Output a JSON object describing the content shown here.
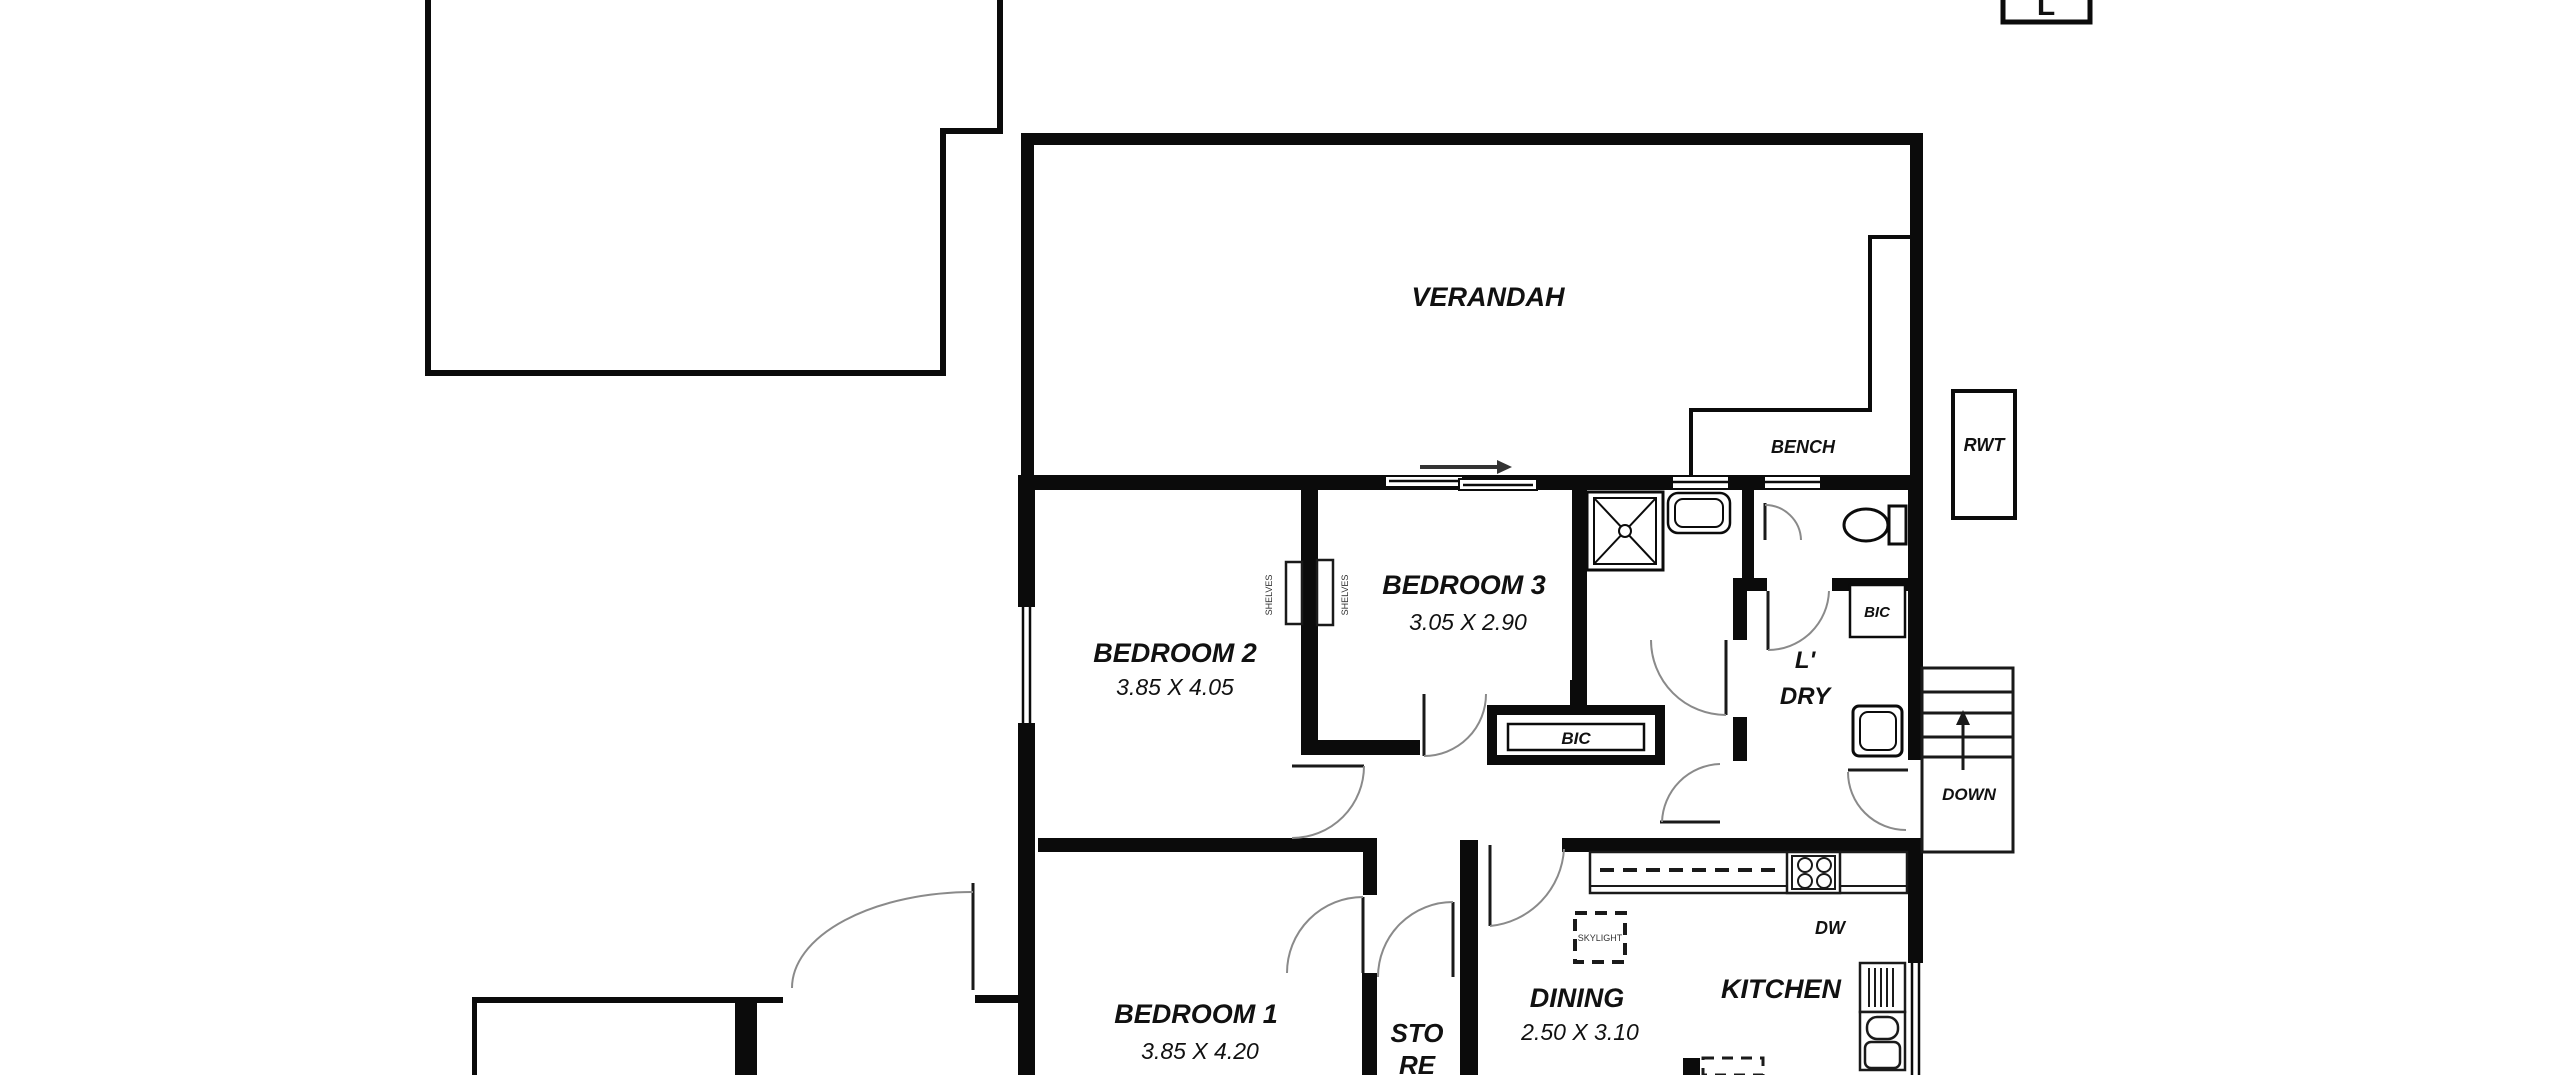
{
  "corner_marker": "L",
  "outdoor": {
    "verandah": "VERANDAH",
    "bench": "BENCH",
    "rwt": "RWT",
    "down": "DOWN"
  },
  "rooms": {
    "bedroom1": {
      "name": "BEDROOM 1",
      "dims": "3.85 X 4.20"
    },
    "bedroom2": {
      "name": "BEDROOM 2",
      "dims": "3.85 X 4.05"
    },
    "bedroom3": {
      "name": "BEDROOM 3",
      "dims": "3.05 X 2.90"
    },
    "dining": {
      "name": "DINING",
      "dims": "2.50 X 3.10"
    },
    "kitchen": {
      "name": "KITCHEN"
    },
    "laundry": {
      "line1": "L'",
      "line2": "DRY"
    },
    "store": {
      "line1": "STO",
      "line2": "RE"
    }
  },
  "fixtures": {
    "bic_hall": "BIC",
    "bic_laundry": "BIC",
    "dishwasher": "DW",
    "skylight": "SKYLIGHT",
    "robe_left": "SHELVES",
    "robe_right": "SHELVES"
  },
  "colors": {
    "wall": "#0b0b0b",
    "background": "#ffffff",
    "arc": "#8a8a8a"
  }
}
